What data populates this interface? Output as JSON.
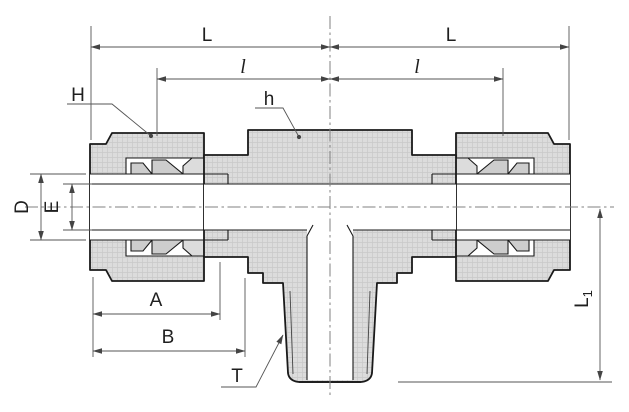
{
  "drawing": {
    "colors": {
      "background": "#ffffff",
      "part_fill": "#dcdcdc",
      "ferrule_fill": "#cdcdcd",
      "outline": "#1a1a1a",
      "dimension_line": "#555555",
      "centerline": "#808080"
    },
    "labels": {
      "length_left": "L",
      "length_right": "L",
      "sub_length_left": "l",
      "sub_length_right": "l",
      "nut_hex": "H",
      "body_hex": "h",
      "diameter_outer": "D",
      "diameter_bore": "E",
      "dim_a": "A",
      "dim_b": "B",
      "thread": "T",
      "branch_length": {
        "main": "L",
        "sub": "1"
      }
    }
  }
}
